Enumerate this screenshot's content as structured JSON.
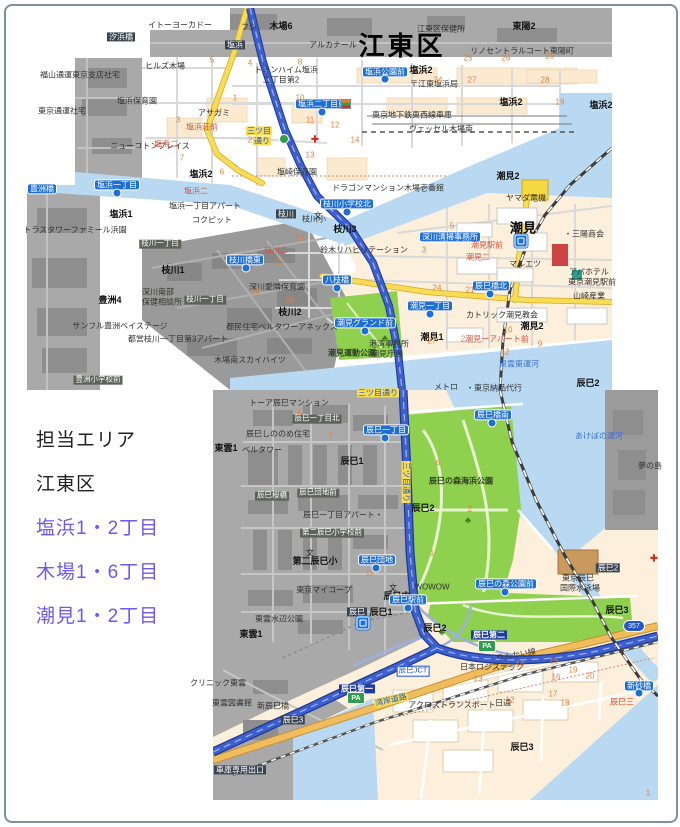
{
  "panel": {
    "title": "担当エリア",
    "ward": "江東区",
    "areas": [
      "塩浜1・2丁目",
      "木場1・6丁目",
      "潮見1・2丁目"
    ],
    "area_text_color": "#6a5af2"
  },
  "map": {
    "colors": {
      "water": "#b9d9f2",
      "out_of_area_gray": "#a9a9a9",
      "block_cream": "#fcf0dc",
      "park_green": "#8fd14e",
      "road_yellow": "#f7dd55",
      "highway_blue": "#3d5fd0",
      "bus_stop_label": "#1d6fd6",
      "wangan_road_orange": "#f0bd5e"
    },
    "labels": [
      {
        "t": "イトーヨーカドー",
        "x": 180,
        "y": 25,
        "c": "pl"
      },
      {
        "t": "フジ",
        "x": 249,
        "y": 27,
        "c": "pl"
      },
      {
        "t": "木場6",
        "x": 281,
        "y": 26,
        "c": "bd"
      },
      {
        "t": "アルカナール",
        "x": 333,
        "y": 45,
        "c": "pl"
      },
      {
        "t": "江東区保健所",
        "x": 441,
        "y": 29,
        "c": "pl"
      },
      {
        "t": "東陽2",
        "x": 524,
        "y": 26,
        "c": "bd"
      },
      {
        "t": "汐浜橋",
        "x": 121,
        "y": 37,
        "c": "dk"
      },
      {
        "t": "塩浜",
        "x": 235,
        "y": 45,
        "c": "dk"
      },
      {
        "t": "江東区",
        "x": 402,
        "y": 47,
        "c": "big"
      },
      {
        "t": "リノセントラルコート東陽町",
        "x": 522,
        "y": 51,
        "c": "pl"
      },
      {
        "t": "ヒルズ木場",
        "x": 165,
        "y": 66,
        "c": "pl"
      },
      {
        "t": "塩浜2",
        "x": 421,
        "y": 70,
        "c": "bd"
      },
      {
        "t": "トミンハイム塩浜",
        "x": 286,
        "y": 70,
        "c": "pl"
      },
      {
        "t": "二丁目第2",
        "x": 281,
        "y": 80,
        "c": "pl"
      },
      {
        "t": "〒江東塩浜局",
        "x": 434,
        "y": 84,
        "c": "pl"
      },
      {
        "t": "福山通運東京支店社宅",
        "x": 80,
        "y": 75,
        "c": "pl"
      },
      {
        "t": "塩浜保育園",
        "x": 137,
        "y": 101,
        "c": "pl"
      },
      {
        "t": "アサガミ",
        "x": 214,
        "y": 113,
        "c": "pl"
      },
      {
        "t": "塩浜二丁目東",
        "x": 322,
        "y": 104,
        "c": "bl"
      },
      {
        "t": "塩浜公園前",
        "x": 385,
        "y": 72,
        "c": "bl"
      },
      {
        "t": "塩浜2",
        "x": 511,
        "y": 102,
        "c": "bd"
      },
      {
        "t": "塩浜2",
        "x": 601,
        "y": 105,
        "c": "bd"
      },
      {
        "t": "東京地下鉄東西線車庫",
        "x": 412,
        "y": 115,
        "c": "pl"
      },
      {
        "t": "ヴェッセル木場南",
        "x": 441,
        "y": 129,
        "c": "pl"
      },
      {
        "t": "東京通運社宅",
        "x": 62,
        "y": 111,
        "c": "pl"
      },
      {
        "t": "塩浜荘前",
        "x": 202,
        "y": 127,
        "c": "rd"
      },
      {
        "t": "ニューコトンプレイス",
        "x": 150,
        "y": 146,
        "c": "pl"
      },
      {
        "t": "三ツ目",
        "x": 259,
        "y": 131,
        "c": "road"
      },
      {
        "t": "通り",
        "x": 262,
        "y": 141,
        "c": "road"
      },
      {
        "t": "塩浜二",
        "x": 166,
        "y": 144,
        "c": "rd"
      },
      {
        "t": "塩浜2",
        "x": 201,
        "y": 174,
        "c": "bd"
      },
      {
        "t": "塩崎保育園",
        "x": 297,
        "y": 172,
        "c": "pl"
      },
      {
        "t": "塩浜一丁目",
        "x": 117,
        "y": 185,
        "c": "bl"
      },
      {
        "t": "塩浜二",
        "x": 196,
        "y": 191,
        "c": "rd"
      },
      {
        "t": "豊洲橋",
        "x": 42,
        "y": 189,
        "c": "bl"
      },
      {
        "t": "塩浜一丁目アパート",
        "x": 205,
        "y": 206,
        "c": "pl"
      },
      {
        "t": "塩浜1",
        "x": 121,
        "y": 214,
        "c": "bd"
      },
      {
        "t": "コクピット",
        "x": 212,
        "y": 220,
        "c": "pl"
      },
      {
        "t": "トラスタワーファミール浜園",
        "x": 75,
        "y": 230,
        "c": "pl"
      },
      {
        "t": "枝川",
        "x": 286,
        "y": 214,
        "c": "dk"
      },
      {
        "t": "枝川小学校北",
        "x": 347,
        "y": 204,
        "c": "bl"
      },
      {
        "t": "枝川小",
        "x": 314,
        "y": 219,
        "c": "pl"
      },
      {
        "t": "枝川3",
        "x": 345,
        "y": 229,
        "c": "bd"
      },
      {
        "t": "ドラゴンマンション木場壱番館",
        "x": 388,
        "y": 188,
        "c": "pl"
      },
      {
        "t": "枝川一丁目",
        "x": 160,
        "y": 244,
        "c": "dkg"
      },
      {
        "t": "枝川1",
        "x": 173,
        "y": 270,
        "c": "bd"
      },
      {
        "t": "枝川橋東",
        "x": 245,
        "y": 260,
        "c": "bl"
      },
      {
        "t": "枝川二",
        "x": 276,
        "y": 250,
        "c": "rd"
      },
      {
        "t": "鈴木リハビリテーション",
        "x": 364,
        "y": 250,
        "c": "pl"
      },
      {
        "t": "深川愛隣保育園",
        "x": 277,
        "y": 287,
        "c": "pl"
      },
      {
        "t": "八枝橋",
        "x": 337,
        "y": 280,
        "c": "bl"
      },
      {
        "t": "深川南部",
        "x": 158,
        "y": 292,
        "c": "pl"
      },
      {
        "t": "保健相談所",
        "x": 162,
        "y": 302,
        "c": "pl"
      },
      {
        "t": "枝川一丁目",
        "x": 205,
        "y": 300,
        "c": "dkg"
      },
      {
        "t": "豊洲4",
        "x": 110,
        "y": 300,
        "c": "bd"
      },
      {
        "t": "枝川2",
        "x": 290,
        "y": 312,
        "c": "bd"
      },
      {
        "t": "サンフル豊洲ベイステージ",
        "x": 120,
        "y": 326,
        "c": "pl"
      },
      {
        "t": "都営枝川一丁目第3アパート",
        "x": 178,
        "y": 339,
        "c": "pl"
      },
      {
        "t": "都民住宅ベルタワーアネックス",
        "x": 282,
        "y": 327,
        "c": "pl"
      },
      {
        "t": "木場南スカイハイツ",
        "x": 250,
        "y": 360,
        "c": "pl"
      },
      {
        "t": "豊洲小学校前",
        "x": 98,
        "y": 380,
        "c": "dkg"
      },
      {
        "t": "潮見2",
        "x": 508,
        "y": 176,
        "c": "bd"
      },
      {
        "t": "ヤマダ電機",
        "x": 526,
        "y": 198,
        "c": "pl"
      },
      {
        "t": "潮見",
        "x": 523,
        "y": 229,
        "c": "bigst"
      },
      {
        "t": "・三陽商会",
        "x": 584,
        "y": 234,
        "c": "pl"
      },
      {
        "t": "深川清掃事務所",
        "x": 450,
        "y": 237,
        "c": "bl"
      },
      {
        "t": "潮見駅前",
        "x": 487,
        "y": 245,
        "c": "rd"
      },
      {
        "t": "潮見二",
        "x": 478,
        "y": 257,
        "c": "rd"
      },
      {
        "t": "マルエツ",
        "x": 525,
        "y": 264,
        "c": "pl"
      },
      {
        "t": "アパホテル",
        "x": 589,
        "y": 272,
        "c": "pl"
      },
      {
        "t": "東京潮見駅前",
        "x": 592,
        "y": 282,
        "c": "pl"
      },
      {
        "t": "辰巳橋北",
        "x": 491,
        "y": 286,
        "c": "bl"
      },
      {
        "t": "山崎産業",
        "x": 589,
        "y": 296,
        "c": "pl"
      },
      {
        "t": "潮見一丁目",
        "x": 430,
        "y": 306,
        "c": "bl"
      },
      {
        "t": "カトリック潮見教会",
        "x": 502,
        "y": 315,
        "c": "pl"
      },
      {
        "t": "潮見1",
        "x": 432,
        "y": 337,
        "c": "bd"
      },
      {
        "t": "潮見一アパート前",
        "x": 497,
        "y": 339,
        "c": "rd"
      },
      {
        "t": "潮見2",
        "x": 532,
        "y": 326,
        "c": "bd"
      },
      {
        "t": "潮見グランド前",
        "x": 365,
        "y": 323,
        "c": "bl"
      },
      {
        "t": "潮見運動公園",
        "x": 352,
        "y": 353,
        "c": "grl"
      },
      {
        "t": "港湾事務所",
        "x": 389,
        "y": 344,
        "c": "pl"
      },
      {
        "t": "潮見庁舎",
        "x": 387,
        "y": 354,
        "c": "pl"
      },
      {
        "t": "東雲東運河",
        "x": 519,
        "y": 364,
        "c": "wat"
      },
      {
        "t": "メトロ",
        "x": 446,
        "y": 387,
        "c": "pl"
      },
      {
        "t": "・東京納品代行",
        "x": 494,
        "y": 388,
        "c": "pl"
      },
      {
        "t": "三ツ目通り",
        "x": 378,
        "y": 393,
        "c": "road"
      },
      {
        "t": "トーア辰巳マンション",
        "x": 289,
        "y": 403,
        "c": "pl"
      },
      {
        "t": "辰巳一丁目北",
        "x": 317,
        "y": 419,
        "c": "dkg"
      },
      {
        "t": "辰巳一丁目",
        "x": 386,
        "y": 430,
        "c": "bl"
      },
      {
        "t": "辰巳しののめ住宅",
        "x": 278,
        "y": 434,
        "c": "pl"
      },
      {
        "t": "東雲1",
        "x": 226,
        "y": 448,
        "c": "bd"
      },
      {
        "t": "ベルタワー",
        "x": 262,
        "y": 450,
        "c": "pl"
      },
      {
        "t": "辰巳1",
        "x": 352,
        "y": 461,
        "c": "bd"
      },
      {
        "t": "三ツ目通り",
        "x": 406,
        "y": 482,
        "c": "road",
        "r": 90
      },
      {
        "t": "辰巳の森海浜公園",
        "x": 461,
        "y": 481,
        "c": "grl"
      },
      {
        "t": "辰巳桜橋",
        "x": 272,
        "y": 496,
        "c": "dkg"
      },
      {
        "t": "辰巳団地前",
        "x": 318,
        "y": 493,
        "c": "dkg"
      },
      {
        "t": "辰巳2",
        "x": 423,
        "y": 508,
        "c": "bd"
      },
      {
        "t": "辰巳一丁目アパート・",
        "x": 343,
        "y": 515,
        "c": "pl"
      },
      {
        "t": "第二辰巳小学校前",
        "x": 332,
        "y": 533,
        "c": "dkg"
      },
      {
        "t": "辰巳団地",
        "x": 377,
        "y": 560,
        "c": "bl"
      },
      {
        "t": "第二辰巳小",
        "x": 315,
        "y": 561,
        "c": "bd"
      },
      {
        "t": "東京マイコープ",
        "x": 324,
        "y": 590,
        "c": "pl"
      },
      {
        "t": "辰巳中",
        "x": 397,
        "y": 596,
        "c": "bd"
      },
      {
        "t": "辰巳2",
        "x": 588,
        "y": 383,
        "c": "bd"
      },
      {
        "t": "あけぼの運河",
        "x": 599,
        "y": 436,
        "c": "wat"
      },
      {
        "t": "夢の島",
        "x": 650,
        "y": 466,
        "c": "pl"
      },
      {
        "t": "WOWOW",
        "x": 432,
        "y": 587,
        "c": "pl"
      },
      {
        "t": "辰巳の森公園前",
        "x": 506,
        "y": 584,
        "c": "bl"
      },
      {
        "t": "辰巳駅前",
        "x": 408,
        "y": 600,
        "c": "bl"
      },
      {
        "t": "辰巳",
        "x": 357,
        "y": 612,
        "c": "dk"
      },
      {
        "t": "辰巳1",
        "x": 381,
        "y": 612,
        "c": "bd"
      },
      {
        "t": "辰巳2",
        "x": 435,
        "y": 628,
        "c": "bd"
      },
      {
        "t": "辰巳第二",
        "x": 489,
        "y": 635,
        "c": "nv"
      },
      {
        "t": "辰巳JCT",
        "x": 413,
        "y": 671,
        "c": "jct"
      },
      {
        "t": "辰巳第一",
        "x": 357,
        "y": 689,
        "c": "nv"
      },
      {
        "t": "湾岸道路",
        "x": 391,
        "y": 700,
        "c": "road",
        "r": -13
      },
      {
        "t": "りんかい線",
        "x": 516,
        "y": 655,
        "c": "pl",
        "r": -10
      },
      {
        "t": "日本ロジステック",
        "x": 492,
        "y": 667,
        "c": "pl"
      },
      {
        "t": "クリニック東雲",
        "x": 218,
        "y": 683,
        "c": "pl"
      },
      {
        "t": "東雲図書館",
        "x": 232,
        "y": 703,
        "c": "pl"
      },
      {
        "t": "新辰巳橋",
        "x": 273,
        "y": 706,
        "c": "pl"
      },
      {
        "t": "東雲水辺公園",
        "x": 279,
        "y": 619,
        "c": "pl"
      },
      {
        "t": "東雲1",
        "x": 251,
        "y": 634,
        "c": "bd"
      },
      {
        "t": "辰巳3",
        "x": 293,
        "y": 720,
        "c": "dk"
      },
      {
        "t": "アクロストランスポート",
        "x": 452,
        "y": 705,
        "c": "pl"
      },
      {
        "t": "日通",
        "x": 503,
        "y": 703,
        "c": "pl"
      },
      {
        "t": "辰巳3",
        "x": 522,
        "y": 747,
        "c": "bd"
      },
      {
        "t": "辰巳3",
        "x": 617,
        "y": 610,
        "c": "bd"
      },
      {
        "t": "新砂橋",
        "x": 639,
        "y": 686,
        "c": "bl"
      },
      {
        "t": "辰巳三",
        "x": 622,
        "y": 702,
        "c": "rd"
      },
      {
        "t": "車庫専用出口",
        "x": 240,
        "y": 770,
        "c": "dk"
      },
      {
        "t": "東京辰巳",
        "x": 578,
        "y": 578,
        "c": "pl"
      },
      {
        "t": "国際水泳場",
        "x": 580,
        "y": 588,
        "c": "pl"
      },
      {
        "t": "辰巳橋南",
        "x": 493,
        "y": 415,
        "c": "bl"
      },
      {
        "t": "辰巳2",
        "x": 608,
        "y": 568,
        "c": "dk"
      }
    ],
    "numbers": [
      {
        "n": "4",
        "x": 250,
        "y": 63
      },
      {
        "n": "5",
        "x": 212,
        "y": 60
      },
      {
        "n": "8",
        "x": 300,
        "y": 62
      },
      {
        "n": "25",
        "x": 468,
        "y": 58
      },
      {
        "n": "26",
        "x": 506,
        "y": 58
      },
      {
        "n": "29",
        "x": 550,
        "y": 56
      },
      {
        "n": "24",
        "x": 438,
        "y": 80
      },
      {
        "n": "27",
        "x": 472,
        "y": 80
      },
      {
        "n": "28",
        "x": 545,
        "y": 80
      },
      {
        "n": "19",
        "x": 560,
        "y": 102
      },
      {
        "n": "3",
        "x": 178,
        "y": 120
      },
      {
        "n": "1",
        "x": 235,
        "y": 98
      },
      {
        "n": "7",
        "x": 182,
        "y": 158
      },
      {
        "n": "6",
        "x": 222,
        "y": 172
      },
      {
        "n": "2",
        "x": 250,
        "y": 140
      },
      {
        "n": "11",
        "x": 310,
        "y": 120
      },
      {
        "n": "12",
        "x": 335,
        "y": 125
      },
      {
        "n": "10",
        "x": 300,
        "y": 98
      },
      {
        "n": "14",
        "x": 355,
        "y": 140
      },
      {
        "n": "13",
        "x": 310,
        "y": 155
      },
      {
        "n": "24",
        "x": 300,
        "y": 238
      },
      {
        "n": "25",
        "x": 280,
        "y": 262
      },
      {
        "n": "14",
        "x": 255,
        "y": 292
      },
      {
        "n": "26",
        "x": 290,
        "y": 300
      },
      {
        "n": "5",
        "x": 452,
        "y": 226
      },
      {
        "n": "3",
        "x": 424,
        "y": 250
      },
      {
        "n": "21",
        "x": 470,
        "y": 290
      },
      {
        "n": "24",
        "x": 437,
        "y": 288
      },
      {
        "n": "27",
        "x": 432,
        "y": 341
      },
      {
        "n": "2",
        "x": 463,
        "y": 339
      },
      {
        "n": "10",
        "x": 508,
        "y": 330
      },
      {
        "n": "9",
        "x": 540,
        "y": 344
      },
      {
        "n": "12",
        "x": 505,
        "y": 352
      },
      {
        "n": "5",
        "x": 300,
        "y": 413
      },
      {
        "n": "7",
        "x": 330,
        "y": 436
      },
      {
        "n": "12",
        "x": 370,
        "y": 573
      },
      {
        "n": "2",
        "x": 470,
        "y": 509
      },
      {
        "n": "6",
        "x": 438,
        "y": 463
      },
      {
        "n": "1",
        "x": 432,
        "y": 553
      },
      {
        "n": "14",
        "x": 520,
        "y": 664
      },
      {
        "n": "15",
        "x": 554,
        "y": 661
      },
      {
        "n": "16",
        "x": 556,
        "y": 677
      },
      {
        "n": "17",
        "x": 553,
        "y": 694
      },
      {
        "n": "18",
        "x": 565,
        "y": 703
      },
      {
        "n": "20",
        "x": 590,
        "y": 676
      },
      {
        "n": "19",
        "x": 573,
        "y": 670
      },
      {
        "n": "13",
        "x": 478,
        "y": 679
      },
      {
        "n": "12",
        "x": 510,
        "y": 700
      },
      {
        "n": "1",
        "x": 648,
        "y": 793
      }
    ],
    "icons": [
      {
        "k": "station-jr",
        "x": 521,
        "y": 241
      },
      {
        "k": "station-metro",
        "x": 363,
        "y": 623
      },
      {
        "k": "pa",
        "x": 487,
        "y": 646
      },
      {
        "k": "pa",
        "x": 356,
        "y": 698
      },
      {
        "k": "shield357",
        "x": 634,
        "y": 626
      },
      {
        "k": "redcross",
        "x": 315,
        "y": 140
      },
      {
        "k": "redcross",
        "x": 654,
        "y": 559
      },
      {
        "k": "seven",
        "x": 346,
        "y": 104
      },
      {
        "k": "school",
        "x": 318,
        "y": 216
      },
      {
        "k": "school",
        "x": 310,
        "y": 553
      },
      {
        "k": "school",
        "x": 393,
        "y": 588
      },
      {
        "k": "tree",
        "x": 385,
        "y": 338
      },
      {
        "k": "tree",
        "x": 468,
        "y": 520
      },
      {
        "k": "tree",
        "x": 442,
        "y": 632
      },
      {
        "k": "ramp-dot",
        "x": 284,
        "y": 139
      }
    ],
    "icon_glyphs": {
      "pa": "PA",
      "shield357": "357",
      "redcross": "✚",
      "school": "文",
      "tree": "♣"
    },
    "bus_stops": [
      {
        "x": 117,
        "y": 193
      },
      {
        "x": 322,
        "y": 112
      },
      {
        "x": 347,
        "y": 212
      },
      {
        "x": 246,
        "y": 268
      },
      {
        "x": 337,
        "y": 288
      },
      {
        "x": 365,
        "y": 331
      },
      {
        "x": 430,
        "y": 314
      },
      {
        "x": 490,
        "y": 294
      },
      {
        "x": 385,
        "y": 438
      },
      {
        "x": 408,
        "y": 608
      },
      {
        "x": 505,
        "y": 592
      },
      {
        "x": 376,
        "y": 568
      },
      {
        "x": 492,
        "y": 423
      },
      {
        "x": 639,
        "y": 693
      },
      {
        "x": 385,
        "y": 79
      }
    ]
  }
}
